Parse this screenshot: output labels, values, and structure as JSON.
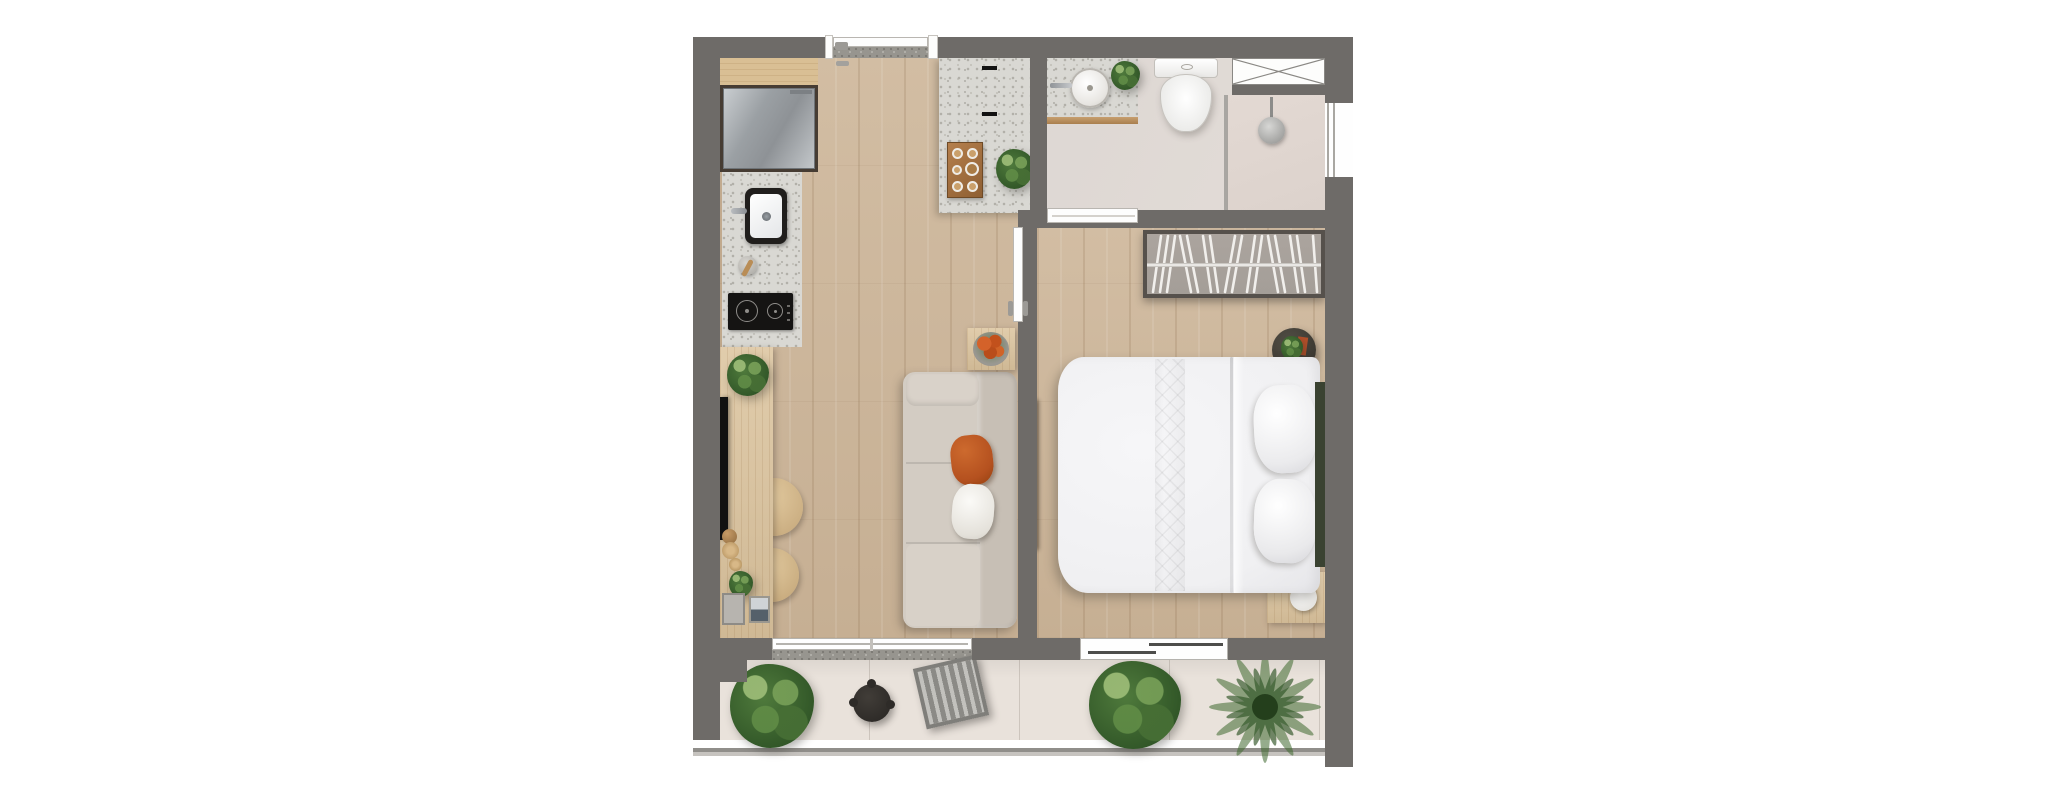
{
  "palette": {
    "wall": "#6e6b68",
    "floor_wood": "#ccb69b",
    "balcony_floor": "#e9e2db",
    "terrazzo": "#d9d8d3",
    "terrazzo_dot": "#b2b0a9",
    "granite": "#97958f",
    "wood_furniture": "#dcc49e",
    "sofa": "#d3ccc3",
    "sofa_back": "#c7bfb5",
    "pillow_orange": "#b5511f",
    "bed_white": "#f0f0f2",
    "headboard": "#3a4231",
    "tv_black": "#111111",
    "plant_green": "#4f7a3c",
    "plant_dark": "#2f5426",
    "stool": "#d6ba8e",
    "fridge_light": "#c9cdd0",
    "fridge_dark": "#8e9296",
    "wardrobe_interior": "#a49e98",
    "wardrobe_border": "#56514c",
    "table_black": "#2e2b28",
    "railing_line": "#908e8a"
  },
  "rooms": {
    "living": "living-kitchen",
    "bedroom": "bedroom",
    "bathroom": "bathroom",
    "balcony": "balcony"
  },
  "inventory": {
    "kitchen": [
      "upper-wood-counter",
      "refrigerator",
      "sink-counter",
      "kitchen-sink",
      "mortar-and-pestle",
      "cooktop-two-burners"
    ],
    "living": [
      "tv-panel",
      "wood-desk",
      "round-stool",
      "round-stool",
      "decor-frames",
      "sofa",
      "orange-pillow",
      "white-pillow",
      "flower-side-table",
      "entry-console",
      "console-tray",
      "plants"
    ],
    "bedroom": [
      "sliding-door",
      "wardrobe",
      "double-bed",
      "pillows",
      "headboard",
      "plant-side-table",
      "nightstand-with-lamp",
      "tv-panel",
      "window-to-balcony"
    ],
    "bathroom": [
      "door",
      "vanity-round-sink",
      "toilet",
      "glass-partition",
      "shower-head",
      "service-shaft",
      "window"
    ],
    "balcony": [
      "fiddle-leaf-plant",
      "black-coffee-table",
      "slatted-lounge-chair",
      "monstera-plant",
      "palm-plant",
      "glass-railing",
      "sliding-doorway",
      "threshold"
    ]
  }
}
